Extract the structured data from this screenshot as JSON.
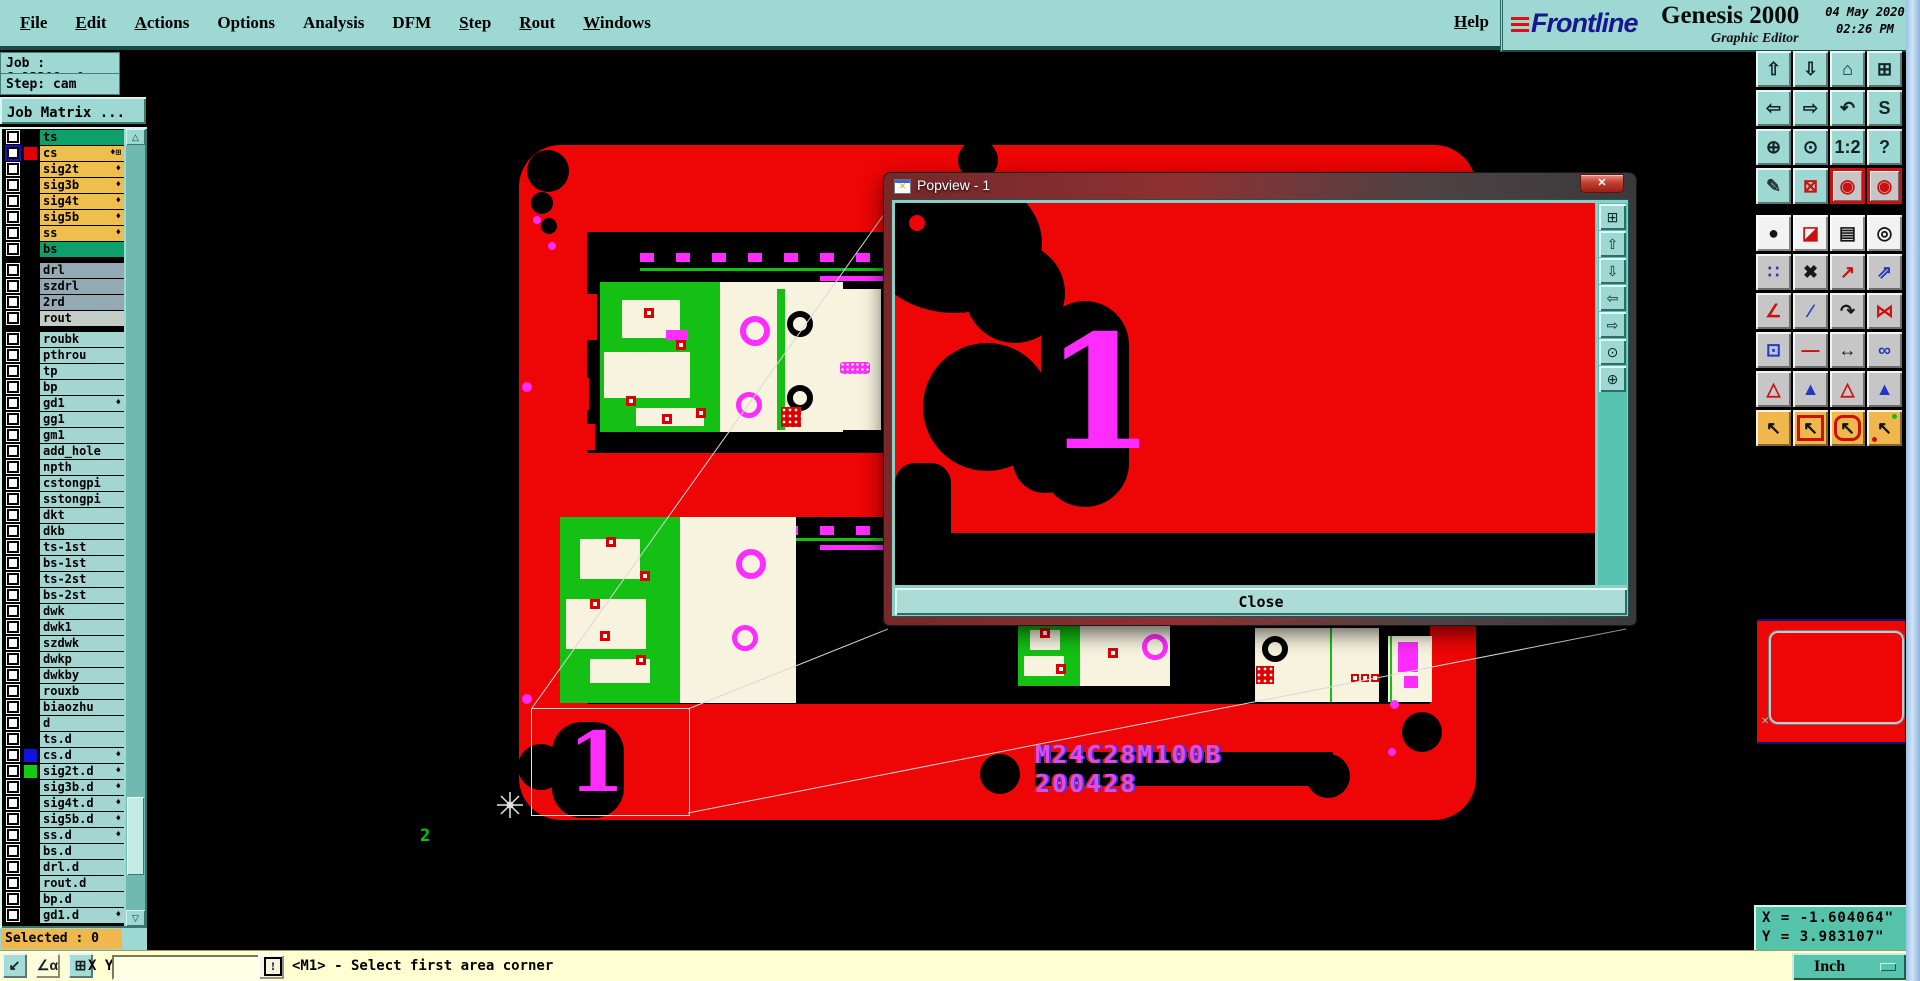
{
  "titlebar": {
    "menus": [
      {
        "label": "File",
        "u": "1"
      },
      {
        "label": "Edit",
        "u": "1"
      },
      {
        "label": "Actions",
        "u": "1"
      },
      {
        "label": "Options",
        "u": "0"
      },
      {
        "label": "Analysis",
        "u": "0"
      },
      {
        "label": "DFM",
        "u": "0"
      },
      {
        "label": "Step",
        "u": "1"
      },
      {
        "label": "Rout",
        "u": "1"
      },
      {
        "label": "Windows",
        "u": "1"
      }
    ],
    "help": "Help",
    "brand": {
      "name": "Frontline",
      "product": "Genesis 2000",
      "subtitle": "Graphic Editor",
      "date_line1": "04 May 2020",
      "date_line2": "02:26 PM"
    }
  },
  "job_panel": {
    "job": "Job : 6s13308sa0",
    "step": "Step: cam",
    "matrix_button": "Job Matrix ...",
    "selected": "Selected : 0"
  },
  "layers": [
    {
      "n": "ts",
      "bg": "#0ea06a",
      "mk": ""
    },
    {
      "n": "cs",
      "bg": "#eebe4e",
      "sw": "#e00000",
      "mk": "♦⊞",
      "cb": "blue"
    },
    {
      "n": "sig2t",
      "bg": "#eebe4e",
      "mk": "♦"
    },
    {
      "n": "sig3b",
      "bg": "#eebe4e",
      "mk": "♦"
    },
    {
      "n": "sig4t",
      "bg": "#eebe4e",
      "mk": "♦"
    },
    {
      "n": "sig5b",
      "bg": "#eebe4e",
      "mk": "♦"
    },
    {
      "n": "ss",
      "bg": "#eebe4e",
      "mk": "♦"
    },
    {
      "n": "bs",
      "bg": "#0ea06a",
      "mk": ""
    },
    {
      "n": "drl",
      "bg": "#93a9b3",
      "mk": "",
      "gap": "1"
    },
    {
      "n": "szdrl",
      "bg": "#93a9b3",
      "mk": ""
    },
    {
      "n": "2rd",
      "bg": "#93a9b3",
      "mk": ""
    },
    {
      "n": "rout",
      "bg": "#c3ccc5",
      "mk": ""
    },
    {
      "n": "roubk",
      "bg": "#a3d5d1",
      "mk": "",
      "gap": "1"
    },
    {
      "n": "pthrou",
      "bg": "#a3d5d1",
      "mk": ""
    },
    {
      "n": "tp",
      "bg": "#a3d5d1",
      "mk": ""
    },
    {
      "n": "bp",
      "bg": "#a3d5d1",
      "mk": ""
    },
    {
      "n": "gd1",
      "bg": "#a3d5d1",
      "mk": "♦"
    },
    {
      "n": "gg1",
      "bg": "#a3d5d1",
      "mk": ""
    },
    {
      "n": "gm1",
      "bg": "#a3d5d1",
      "mk": ""
    },
    {
      "n": "add_hole",
      "bg": "#a3d5d1",
      "mk": ""
    },
    {
      "n": "npth",
      "bg": "#a3d5d1",
      "mk": ""
    },
    {
      "n": "cstongpi",
      "bg": "#a3d5d1",
      "mk": ""
    },
    {
      "n": "sstongpi",
      "bg": "#a3d5d1",
      "mk": ""
    },
    {
      "n": "dkt",
      "bg": "#a3d5d1",
      "mk": ""
    },
    {
      "n": "dkb",
      "bg": "#a3d5d1",
      "mk": ""
    },
    {
      "n": "ts-1st",
      "bg": "#a3d5d1",
      "mk": ""
    },
    {
      "n": "bs-1st",
      "bg": "#a3d5d1",
      "mk": ""
    },
    {
      "n": "ts-2st",
      "bg": "#a3d5d1",
      "mk": ""
    },
    {
      "n": "bs-2st",
      "bg": "#a3d5d1",
      "mk": ""
    },
    {
      "n": "dwk",
      "bg": "#a3d5d1",
      "mk": ""
    },
    {
      "n": "dwk1",
      "bg": "#a3d5d1",
      "mk": ""
    },
    {
      "n": "szdwk",
      "bg": "#a3d5d1",
      "mk": ""
    },
    {
      "n": "dwkp",
      "bg": "#a3d5d1",
      "mk": ""
    },
    {
      "n": "dwkby",
      "bg": "#a3d5d1",
      "mk": ""
    },
    {
      "n": "rouxb",
      "bg": "#a3d5d1",
      "mk": ""
    },
    {
      "n": "biaozhu",
      "bg": "#a3d5d1",
      "mk": ""
    },
    {
      "n": "d",
      "bg": "#a3d5d1",
      "mk": ""
    },
    {
      "n": "ts.d",
      "bg": "#a3d5d1",
      "mk": ""
    },
    {
      "n": "cs.d",
      "bg": "#a3d5d1",
      "sw": "#1212dd",
      "mk": "♦"
    },
    {
      "n": "sig2t.d",
      "bg": "#a3d5d1",
      "sw": "#12cc12",
      "mk": "♦"
    },
    {
      "n": "sig3b.d",
      "bg": "#a3d5d1",
      "mk": "♦"
    },
    {
      "n": "sig4t.d",
      "bg": "#a3d5d1",
      "mk": "♦"
    },
    {
      "n": "sig5b.d",
      "bg": "#a3d5d1",
      "mk": "♦"
    },
    {
      "n": "ss.d",
      "bg": "#a3d5d1",
      "mk": "♦"
    },
    {
      "n": "bs.d",
      "bg": "#a3d5d1",
      "mk": ""
    },
    {
      "n": "drl.d",
      "bg": "#a3d5d1",
      "mk": ""
    },
    {
      "n": "rout.d",
      "bg": "#a3d5d1",
      "mk": ""
    },
    {
      "n": "bp.d",
      "bg": "#a3d5d1",
      "mk": ""
    },
    {
      "n": "gd1.d",
      "bg": "#a3d5d1",
      "mk": "♦"
    }
  ],
  "toolbar": {
    "group1": [
      {
        "n": "clipboard-up-button",
        "g": "⇧",
        "c": "#102424",
        "k": "t"
      },
      {
        "n": "clipboard-down-button",
        "g": "⇩",
        "c": "#102424",
        "k": "t"
      },
      {
        "n": "home-view-button",
        "g": "⌂",
        "c": "#102424",
        "k": "t"
      },
      {
        "n": "window-xy-button",
        "g": "⊞",
        "c": "#102424",
        "k": "t"
      },
      {
        "n": "pan-left-button",
        "g": "⇦",
        "c": "#102424",
        "k": "t"
      },
      {
        "n": "pan-right-button",
        "g": "⇨",
        "c": "#102424",
        "k": "t"
      },
      {
        "n": "previous-view-button",
        "g": "↶",
        "c": "#102424",
        "k": "t"
      },
      {
        "n": "serpentine-button",
        "g": "S",
        "c": "#102424",
        "k": "t"
      },
      {
        "n": "zoom-fit-button",
        "g": "⊕",
        "c": "#102424",
        "k": "t"
      },
      {
        "n": "zoom-center-button",
        "g": "⊙",
        "c": "#102424",
        "k": "t"
      },
      {
        "n": "scale-1-2-button",
        "g": "1:2",
        "c": "#102424",
        "k": "t",
        "sml": "1"
      },
      {
        "n": "help-mode-button",
        "g": "?",
        "c": "#102424",
        "k": "t"
      },
      {
        "n": "tools-setup-button",
        "g": "✎",
        "c": "#203434",
        "k": "t"
      },
      {
        "n": "probe-button",
        "g": "⊠",
        "c": "#cc1010",
        "k": "t"
      },
      {
        "n": "net-lights-a-button",
        "g": "◉",
        "c": "#cc1010",
        "k": "rf"
      },
      {
        "n": "net-lights-b-button",
        "g": "◉",
        "c": "#cc1010",
        "k": "rf"
      }
    ],
    "group2": [
      {
        "n": "highlight-ball-button",
        "g": "●",
        "c": "#151515",
        "k": "w"
      },
      {
        "n": "layer-swap-button",
        "g": "◪",
        "c": "#cc1010",
        "k": "w"
      },
      {
        "n": "ruler-button",
        "g": "▤",
        "c": "#151515",
        "k": "w"
      },
      {
        "n": "dot-select-button",
        "g": "◎",
        "c": "#151515",
        "k": "w"
      },
      {
        "n": "chain-select-button",
        "g": "∷",
        "c": "#2038c8",
        "k": "g"
      },
      {
        "n": "delete-button",
        "g": "✖",
        "c": "#181818",
        "k": "g"
      },
      {
        "n": "copy-button",
        "g": "↗",
        "c": "#cc1010",
        "k": "g"
      },
      {
        "n": "move-button",
        "g": "⇗",
        "c": "#2038c8",
        "k": "g"
      },
      {
        "n": "angle-measure-button",
        "g": "∠",
        "c": "#cc1010",
        "k": "g"
      },
      {
        "n": "slope-button",
        "g": "∕",
        "c": "#2038c8",
        "k": "g"
      },
      {
        "n": "rotate-button",
        "g": "↷",
        "c": "#181818",
        "k": "g"
      },
      {
        "n": "mirror-button",
        "g": "⋈",
        "c": "#cc1010",
        "k": "g"
      },
      {
        "n": "pad-resize-button",
        "g": "⊡",
        "c": "#2038c8",
        "k": "g"
      },
      {
        "n": "stretch-line-button",
        "g": "―",
        "c": "#cc1010",
        "k": "g"
      },
      {
        "n": "measure-gap-button",
        "g": "↔",
        "c": "#181818",
        "k": "g"
      },
      {
        "n": "touching-shapes-button",
        "g": "∞",
        "c": "#2038c8",
        "k": "g"
      },
      {
        "n": "triangle-fill-button",
        "g": "△",
        "c": "#cc1010",
        "k": "g"
      },
      {
        "n": "triangle-outline-button",
        "g": "▲",
        "c": "#2038c8",
        "k": "g"
      },
      {
        "n": "triangle-open-button",
        "g": "△",
        "c": "#cc1010",
        "k": "g"
      },
      {
        "n": "triangle-base-button",
        "g": "▲",
        "c": "#2038c8",
        "k": "g"
      },
      {
        "n": "select-single-button",
        "g": "↖",
        "c": "#101010",
        "k": "o"
      },
      {
        "n": "select-frame-button",
        "g": "↖",
        "c": "#101010",
        "k": "orf"
      },
      {
        "n": "select-poly-button",
        "g": "↖",
        "c": "#101010",
        "k": "orr"
      },
      {
        "n": "select-net-button",
        "g": "↖",
        "c": "#101010",
        "k": "onet"
      }
    ]
  },
  "popview": {
    "title": "Popview - 1",
    "icon_glyph": "✕",
    "close_glyph": "✕",
    "close_button": "Close",
    "big_label": "1",
    "side_buttons": [
      {
        "n": "popview-detach-button",
        "g": "⊞"
      },
      {
        "n": "popview-pan-up-button",
        "g": "⇧"
      },
      {
        "n": "popview-pan-down-button",
        "g": "⇩"
      },
      {
        "n": "popview-pan-left-button",
        "g": "⇦"
      },
      {
        "n": "popview-pan-right-button",
        "g": "⇨"
      },
      {
        "n": "popview-zoom-in-button",
        "g": "⊙"
      },
      {
        "n": "popview-zoom-out-button",
        "g": "⊕"
      }
    ]
  },
  "canvas": {
    "board_text": "M24C28M100B  200428",
    "marker_1": "1",
    "marker_2": "2"
  },
  "statusbar": {
    "buttons": [
      {
        "n": "resize-mode-button",
        "g": "↙",
        "k": "t"
      },
      {
        "n": "angle-snap-button",
        "g": "∠α",
        "k": "y"
      },
      {
        "n": "grid-snap-button",
        "g": "⊞",
        "k": "t"
      }
    ],
    "xy_label": "X Y :",
    "input_value": "",
    "alert_glyph": "!",
    "message": "<M1> - Select first area corner",
    "units": "Inch"
  },
  "readout": {
    "x": "X = -1.604064\"",
    "y": "Y = 3.983107\""
  },
  "colors": {
    "board_red": "#ee0505",
    "magenta": "#ff2cff",
    "panel_teal": "#9dd8d2",
    "layer_orange": "#eebe4e",
    "layer_green": "#0ea06a",
    "layer_gray": "#93a9b3",
    "layer_cyan": "#a3d5d1",
    "selected_orange": "#f0b84c",
    "status_yellow": "#ffffd2",
    "readout_teal": "#55c2aa"
  }
}
